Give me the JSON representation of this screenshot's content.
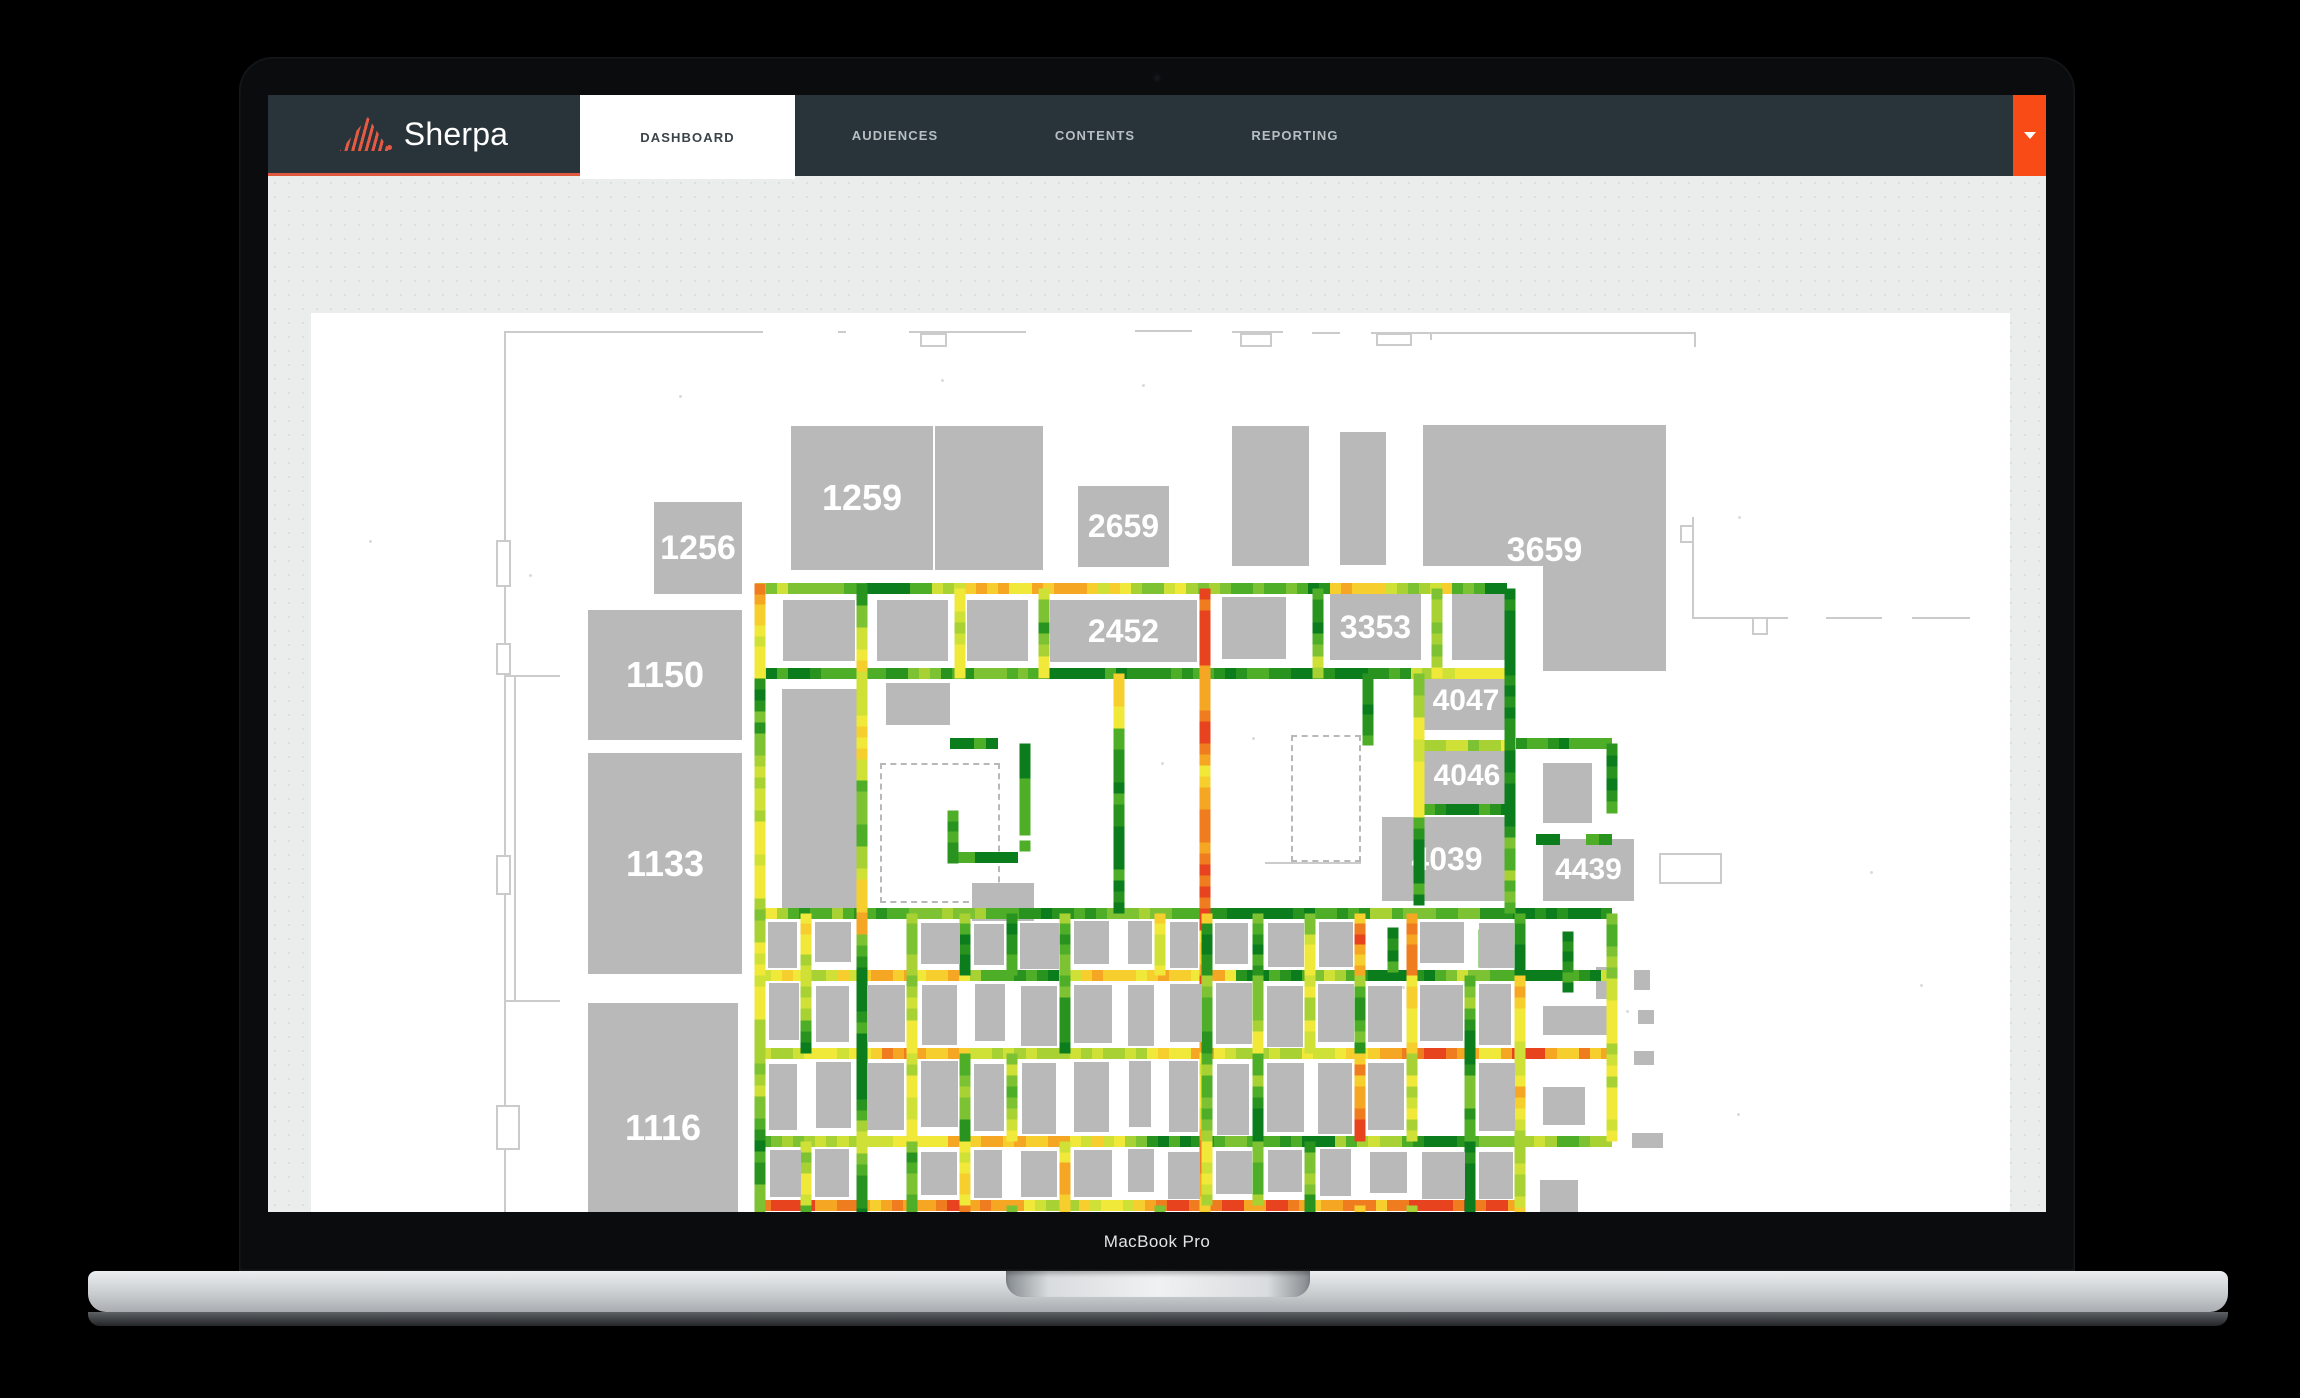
{
  "device": {
    "label": "MacBook Pro"
  },
  "navbar": {
    "brand": "Sherpa",
    "logo_icon": "striped-mountain-logo",
    "tabs": [
      {
        "label": "DASHBOARD",
        "active": true
      },
      {
        "label": "AUDIENCES",
        "active": false
      },
      {
        "label": "CONTENTS",
        "active": false
      },
      {
        "label": "REPORTING",
        "active": false
      }
    ],
    "caret_icon": "chevron-down-icon"
  },
  "colors": {
    "navbar_bg": "#29343a",
    "accent_orange": "#f84b16",
    "logo_orange": "#e65a43",
    "booth_gray": "#b9b9b9",
    "wall_gray": "#cbcbcb",
    "page_bg": "#ebecec",
    "card_bg": "#ffffff"
  },
  "floorplan": {
    "origin": [
      311,
      218
    ],
    "heatmap": {
      "cell": 11,
      "thickness": 11,
      "palette": [
        "#0c7d1c",
        "#28941f",
        "#4fae28",
        "#7cc233",
        "#a8d234",
        "#cfe036",
        "#f1e93a",
        "#f6cf2e",
        "#f5a623",
        "#ef7c1e",
        "#e8431f"
      ],
      "biases": {
        "mixed": {
          "min": 0,
          "max": 8,
          "s0": 2,
          "s1": 7
        },
        "warm": {
          "min": 4,
          "max": 10,
          "s0": 6,
          "s1": 9
        },
        "cool": {
          "min": 0,
          "max": 6,
          "s0": 1,
          "s1": 5
        },
        "cold": {
          "min": 0,
          "max": 2,
          "s0": 0,
          "s1": 1
        }
      },
      "segments": [
        [
          755,
          493,
          1508,
          493,
          "mixed"
        ],
        [
          755,
          578,
          1510,
          578,
          "mixed"
        ],
        [
          755,
          818,
          1612,
          818,
          "mixed"
        ],
        [
          760,
          880,
          1612,
          880,
          "mixed"
        ],
        [
          760,
          958,
          1612,
          958,
          "warm"
        ],
        [
          760,
          1046,
          1612,
          1046,
          "mixed"
        ],
        [
          760,
          1110,
          1520,
          1110,
          "warm"
        ],
        [
          760,
          1172,
          1520,
          1172,
          "warm"
        ],
        [
          1424,
          650,
          1512,
          650,
          "mixed"
        ],
        [
          1424,
          714,
          1512,
          714,
          "cool"
        ],
        [
          1516,
          648,
          1612,
          648,
          "cold"
        ],
        [
          1536,
          744,
          1560,
          744,
          "cold"
        ],
        [
          1586,
          744,
          1612,
          744,
          "cold"
        ],
        [
          950,
          648,
          998,
          648,
          "cold"
        ],
        [
          953,
          762,
          1018,
          762,
          "cold"
        ],
        [
          760,
          488,
          760,
          583,
          "warm"
        ],
        [
          760,
          583,
          760,
          1177,
          "cool"
        ],
        [
          862,
          488,
          862,
          1212,
          "mixed"
        ],
        [
          960,
          493,
          960,
          583,
          "cool"
        ],
        [
          1044,
          493,
          1044,
          583,
          "cool"
        ],
        [
          1205,
          493,
          1205,
          1212,
          "warm"
        ],
        [
          1318,
          493,
          1318,
          583,
          "cool"
        ],
        [
          1437,
          493,
          1437,
          583,
          "cool"
        ],
        [
          1510,
          493,
          1510,
          818,
          "cool"
        ],
        [
          1119,
          578,
          1119,
          818,
          "mixed"
        ],
        [
          1368,
          578,
          1368,
          650,
          "cold"
        ],
        [
          1419,
          578,
          1419,
          810,
          "cool"
        ],
        [
          1612,
          648,
          1612,
          718,
          "cold"
        ],
        [
          1612,
          818,
          1612,
          1046,
          "cool"
        ],
        [
          1520,
          818,
          1520,
          880,
          "cold"
        ],
        [
          1520,
          880,
          1520,
          1212,
          "warm"
        ],
        [
          1470,
          880,
          1470,
          1212,
          "cool"
        ],
        [
          1025,
          648,
          1025,
          740,
          "cold"
        ],
        [
          953,
          715,
          953,
          768,
          "cold"
        ],
        [
          1025,
          745,
          1025,
          756,
          "cold"
        ],
        [
          1393,
          832,
          1393,
          877,
          "cold"
        ],
        [
          1484,
          834,
          1484,
          872,
          "cold"
        ],
        [
          1568,
          836,
          1568,
          897,
          "cold"
        ],
        [
          760,
          1172,
          838,
          1212,
          "cool"
        ]
      ],
      "grid": {
        "rows": [
          818,
          880,
          958,
          1046,
          1110,
          1172,
          1206
        ],
        "cols": [
          760,
          806,
          858,
          912,
          965,
          1012,
          1065,
          1119,
          1160,
          1207,
          1258,
          1310,
          1360,
          1412,
          1470,
          1520
        ],
        "skip_cols": [
          760,
          858,
          862,
          1119,
          1205,
          1470,
          1520
        ],
        "v_bias_pool": [
          "mixed",
          "cool",
          "cool",
          "warm"
        ]
      }
    },
    "booths_labeled": [
      {
        "label": "1256",
        "x": 654,
        "y": 407,
        "w": 88,
        "h": 92,
        "fs": 34
      },
      {
        "label": "1259",
        "x": 791,
        "y": 331,
        "w": 142,
        "h": 144,
        "fs": 36
      },
      {
        "label": "2659",
        "x": 1078,
        "y": 391,
        "w": 91,
        "h": 81,
        "fs": 32
      },
      {
        "label": "1150",
        "x": 588,
        "y": 515,
        "w": 154,
        "h": 130,
        "fs": 36
      },
      {
        "label": "1133",
        "x": 588,
        "y": 658,
        "w": 154,
        "h": 221,
        "fs": 36
      },
      {
        "label": "1116",
        "x": 588,
        "y": 908,
        "w": 150,
        "h": 249,
        "fs": 36
      },
      {
        "label": "2452",
        "x": 1050,
        "y": 505,
        "w": 147,
        "h": 62,
        "fs": 32
      },
      {
        "label": "3353",
        "x": 1330,
        "y": 499,
        "w": 91,
        "h": 66,
        "fs": 32
      },
      {
        "label": "3659",
        "x": 1423,
        "y": 330,
        "w": 243,
        "h": 141,
        "fs": 34,
        "dy": 55
      },
      {
        "label": "4047",
        "x": 1424,
        "y": 577,
        "w": 84,
        "h": 58,
        "fs": 30
      },
      {
        "label": "4046",
        "x": 1424,
        "y": 652,
        "w": 86,
        "h": 58,
        "fs": 30
      },
      {
        "label": "4039",
        "x": 1382,
        "y": 722,
        "w": 130,
        "h": 84,
        "fs": 32
      },
      {
        "label": "4439",
        "x": 1543,
        "y": 744,
        "w": 91,
        "h": 62,
        "fs": 30
      }
    ],
    "booths_plain": [
      [
        935,
        331,
        108,
        144
      ],
      [
        1543,
        471,
        123,
        105
      ],
      [
        1232,
        331,
        77,
        140
      ],
      [
        1340,
        337,
        46,
        133
      ],
      [
        783,
        505,
        72,
        61
      ],
      [
        877,
        505,
        71,
        61
      ],
      [
        967,
        505,
        61,
        61
      ],
      [
        1222,
        502,
        64,
        62
      ],
      [
        1452,
        499,
        56,
        66
      ],
      [
        782,
        594,
        84,
        228
      ],
      [
        886,
        588,
        64,
        42
      ],
      [
        972,
        788,
        62,
        38
      ],
      [
        1543,
        668,
        49,
        60
      ],
      [
        1596,
        872,
        18,
        32
      ],
      [
        1634,
        875,
        16,
        20
      ],
      [
        1638,
        915,
        16,
        14
      ],
      [
        1634,
        956,
        20,
        14
      ],
      [
        1632,
        1038,
        31,
        15
      ],
      [
        1543,
        911,
        67,
        29
      ],
      [
        1543,
        992,
        42,
        38
      ],
      [
        1540,
        1085,
        38,
        60
      ]
    ],
    "walls": {
      "hlines": [
        [
          504,
          236,
          259
        ],
        [
          838,
          236,
          8
        ],
        [
          909,
          236,
          117
        ],
        [
          1135,
          235,
          57
        ],
        [
          1232,
          236,
          51
        ],
        [
          1312,
          237,
          28
        ],
        [
          1371,
          237,
          59
        ],
        [
          1430,
          237,
          264
        ],
        [
          1692,
          522,
          96
        ],
        [
          1826,
          522,
          56
        ],
        [
          1912,
          522,
          58
        ],
        [
          504,
          580,
          56
        ],
        [
          504,
          905,
          56
        ],
        [
          1265,
          767,
          96
        ],
        [
          1640,
          1178,
          350
        ]
      ],
      "vlines": [
        [
          504,
          236,
          959
        ],
        [
          1694,
          237,
          15
        ],
        [
          1692,
          422,
          100
        ],
        [
          1430,
          237,
          8
        ],
        [
          514,
          580,
          325
        ]
      ],
      "rects": [
        [
          920,
          238,
          27,
          14
        ],
        [
          1240,
          238,
          32,
          14
        ],
        [
          1376,
          238,
          36,
          13
        ],
        [
          1680,
          430,
          14,
          18
        ],
        [
          1752,
          522,
          16,
          18
        ],
        [
          496,
          445,
          15,
          47
        ],
        [
          496,
          548,
          15,
          32
        ],
        [
          496,
          760,
          15,
          40
        ],
        [
          496,
          1010,
          24,
          45
        ],
        [
          504,
          1165,
          49,
          45
        ],
        [
          1659,
          758,
          63,
          31
        ],
        [
          1915,
          1160,
          45,
          28
        ],
        [
          1775,
          1128,
          90,
          48
        ]
      ],
      "dashed_rooms": [
        [
          880,
          668,
          120,
          140
        ],
        [
          1291,
          640,
          70,
          127
        ]
      ]
    }
  }
}
